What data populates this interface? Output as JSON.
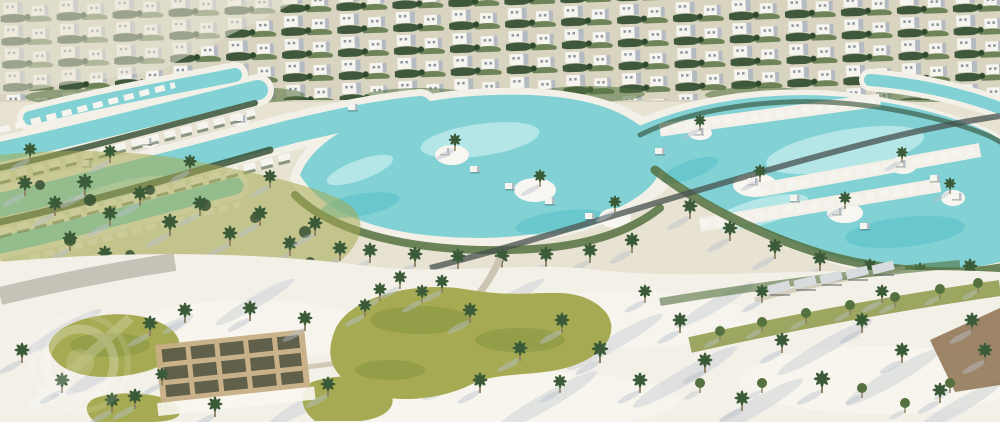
{
  "meta": {
    "description": "Aerial 3D architectural rendering of a resort-style residential community: rows of white villas at the top, a network of winding turquoise crystal lagoons with sandy islands and white cabanas through the middle, and a white-sand park below with scattered palm trees, yellow-green lawns, curving walking paths and a timber pergola deck"
  },
  "palette": {
    "band_base": "#d8d4c0",
    "sand_base": "#e7e2d2",
    "sand_light": "#f3f0e8",
    "sand_bright": "#f8f6f0",
    "sand_shadow": "#b9c2cc",
    "lagoon": "#82d2d5",
    "lagoon_deep": "#58c2c8",
    "lagoon_pale": "#c2ecec",
    "grass": "#a6aa52",
    "grass_dark": "#86943f",
    "veg_dark": "#2f4a2e",
    "veg_mid": "#54713f",
    "palm": "#3b5a38",
    "trunk": "#8f7f63",
    "villa_white": "#f6f4ee",
    "villa_shade": "#b4bac2",
    "window": "#8d949e",
    "road_dark": "#45504d",
    "path_light": "#cdc5b2",
    "promenade": "#c2bdb1",
    "pergola_tan": "#c6ae85",
    "pergola_dark": "#50523f",
    "dirt_brown": "#8d7150",
    "canopy_gray": "#d8dcde",
    "watermark": "#ffffff"
  },
  "watermark": {
    "style": "faint semi-transparent circular ring logo with diagonal slash, bottom-left",
    "opacity": "0.25"
  },
  "scene": {
    "regions": [
      {
        "name": "villa-rows",
        "label": "Rows of white villas with tree-lined garden strips"
      },
      {
        "name": "lagoon-network",
        "label": "Winding turquoise lagoons with sandy islands and white cabanas"
      },
      {
        "name": "palm-grove",
        "label": "Dense palm grove on green lawn, left side"
      },
      {
        "name": "sand-park",
        "label": "White sand park with palms, lawn mounds and curving paths"
      },
      {
        "name": "pergola-deck",
        "label": "Timber lattice pergola lounge deck"
      },
      {
        "name": "shade-canopies",
        "label": "Row of angled shade canopies near lagoon shore"
      }
    ],
    "counts": {
      "villa_rows": 5,
      "lagoon_basins": 3,
      "pergolas": 1
    }
  }
}
